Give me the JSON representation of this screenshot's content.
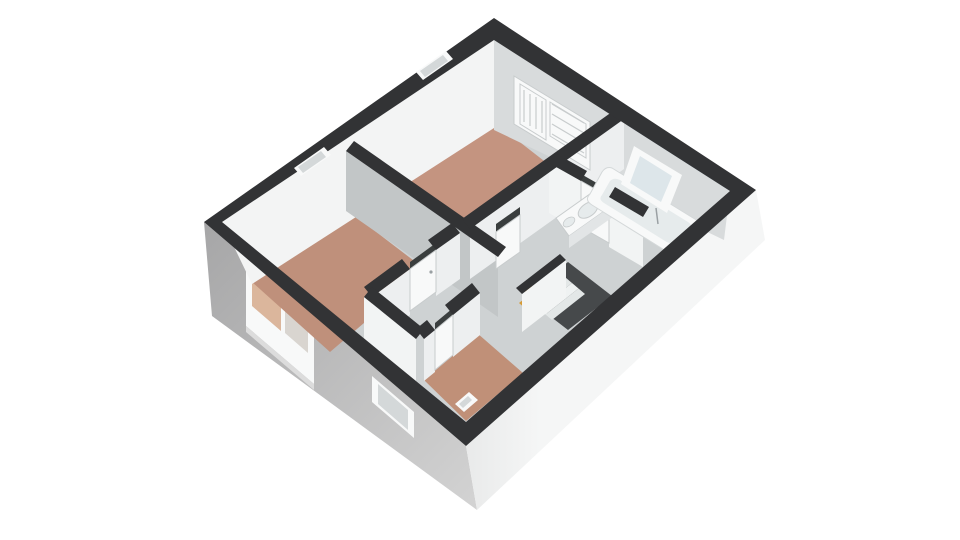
{
  "scene": {
    "kind": "3d-floorplan-render",
    "rooms": [
      {
        "id": "top-bedroom",
        "floor": "wood"
      },
      {
        "id": "lower-bedroom",
        "floor": "wood"
      },
      {
        "id": "small-room",
        "floor": "wood"
      },
      {
        "id": "bathroom",
        "floor": "tile"
      },
      {
        "id": "landing",
        "floor": "hall"
      }
    ],
    "fixtures": [
      "bathtub",
      "vanity-sink",
      "wardrobe",
      "staircase",
      "bathroom-window",
      "bedroom-windows",
      "exterior-windows",
      "interior-doors",
      "exterior-door"
    ]
  },
  "palette": {
    "bg": "#ffffff",
    "wallTop": "#323335",
    "wallTopSoft": "#3a3c3e",
    "extFaceSW1": "#a6a6a7",
    "extFaceSW2": "#d3d3d3",
    "extFaceSE1": "#f5f6f6",
    "extFaceSE2": "#e9eaea",
    "innerFaceLit": "#f3f4f4",
    "innerFaceNE": "#d8dbdc",
    "wallFaceGrey": "#c2c6c7",
    "wallFaceWhite": "#edeff0",
    "wallFaceBright": "#f2f4f4",
    "floorHall": "#ced2d3",
    "floorWoodTop": "#c49480",
    "floorWoodLower": "#bf907b",
    "floorWoodSmall": "#c09078",
    "floorTile": "#abc3d6",
    "stairVoid": "#46494b",
    "stairTread": "#eff2f2",
    "stairWood": "#d69b36",
    "fixtureWhite": "#f8f9f9",
    "fixtureShade": "#e2e5e6",
    "basin": "#e6ebec",
    "paneCool": "#dde6ea",
    "paneGrey": "#d4d8d9",
    "panePeach": "#dbb69c",
    "paneTan": "#d9d5d0",
    "doorSlot": "#3a3e3e",
    "outline": "#c8cccd",
    "metal": "#9aa0a3"
  }
}
